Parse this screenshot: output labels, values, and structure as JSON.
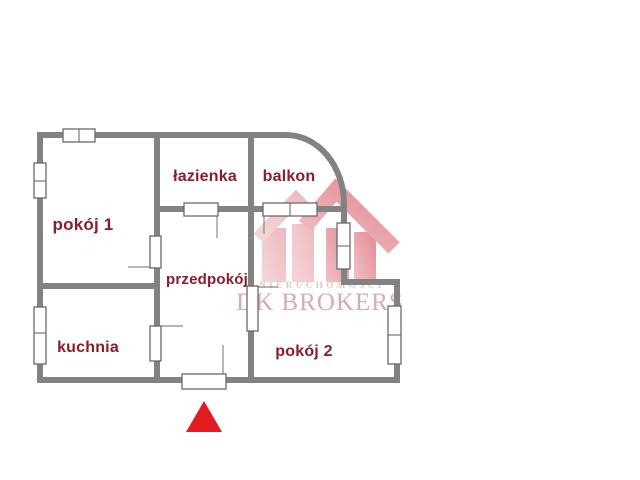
{
  "floorplan": {
    "rooms": [
      {
        "name": "pokoj-1",
        "label": "pokój 1"
      },
      {
        "name": "lazienka",
        "label": "łazienka"
      },
      {
        "name": "balkon",
        "label": "balkon"
      },
      {
        "name": "przedpokoj",
        "label": "przedpokój"
      },
      {
        "name": "kuchnia",
        "label": "kuchnia"
      },
      {
        "name": "pokoj-2",
        "label": "pokój 2"
      }
    ],
    "colors": {
      "wall": "#828282",
      "room_label": "#8e1c2c",
      "window_border": "#6a6a6a",
      "entrance_marker": "#e21b21"
    }
  },
  "watermark": {
    "subtitle": "NIERUCHOMOŚCI",
    "title": "DK BROKERS",
    "colors": {
      "logo_light": "#f3cdd0",
      "logo_mid": "#eba8ae",
      "logo_dark": "#dd6d79",
      "subtitle_text": "#e7c5c8",
      "title_text": "#d9abb1"
    }
  }
}
